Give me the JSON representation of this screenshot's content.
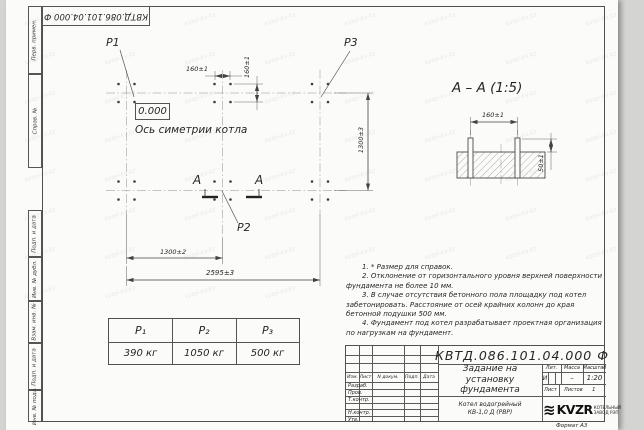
{
  "sheet": {
    "stamp_top": "КВТД.086.101.04.000 Ф",
    "format_label": "Формат А3",
    "watermark_text": "kotel-kv.kz"
  },
  "margin_labels": [
    "Перв. примен.",
    "Справ. №",
    "Подп. и дата",
    "Инв. № дубл.",
    "Взам. инв. №",
    "Подп. и дата",
    "Инв. № подл."
  ],
  "plan": {
    "point_labels": {
      "p1": "P1",
      "p2": "P2",
      "p3": "P3"
    },
    "elevation_mark": "0.000",
    "axis_label": "Ось симетрии котла",
    "section_letter_left": "А",
    "section_letter_right": "А",
    "dims": {
      "bolt_spacing_h": "160±1",
      "bolt_spacing_v": "160±1",
      "row_spacing": "1300±3",
      "col_spacing": "1300±2",
      "overall": "2595±3"
    }
  },
  "section_view": {
    "title": "А – А (1:5)",
    "dims": {
      "bolt_spacing": "160±1",
      "protrusion": "50±1"
    }
  },
  "notes": [
    "1. * Размер для справок.",
    "2. Отклонение от горизонтального уровня верхней поверхности фундамента не более 10 мм.",
    "3. В случае отсутствия бетонного пола площадку под котел забетонировать. Расстояние от осей крайних колонн до края бетонной подушки 500 мм.",
    "4. Фундамент под котел разрабатывает проектная организация по нагрузкам на фундамент."
  ],
  "load_table": {
    "headers": [
      "P₁",
      "P₂",
      "P₃"
    ],
    "values": [
      "390 кг",
      "1050 кг",
      "500 кг"
    ]
  },
  "title_block": {
    "doc_number": "КВТД.086.101.04.000 Ф",
    "title_lines": [
      "Задание на",
      "установку",
      "фундамента"
    ],
    "product_lines": [
      "Котел водогрейный",
      "КВ-1,0 Д (РВР)"
    ],
    "col_headers": {
      "izm": "Изм.",
      "list": "Лист",
      "ndoc": "N докум.",
      "podp": "Подп.",
      "data": "Дата"
    },
    "row_labels": [
      "Разраб.",
      "Пров.",
      "Т.контр.",
      "Н.контр.",
      "Утв."
    ],
    "lit_header": "Лит.",
    "mass_header": "Масса",
    "scale_header": "Масштаб",
    "lit_value": "И",
    "mass_value": "–",
    "scale_value": "1:20",
    "sheet_label": "Лист",
    "sheets_label": "Листов",
    "sheets_value": "1",
    "logo_icon": "≋",
    "logo_text": "KVZR",
    "logo_sub_lines": [
      "КОТЕЛЬНЫЙ",
      "ЗАВОД РЭП"
    ]
  }
}
